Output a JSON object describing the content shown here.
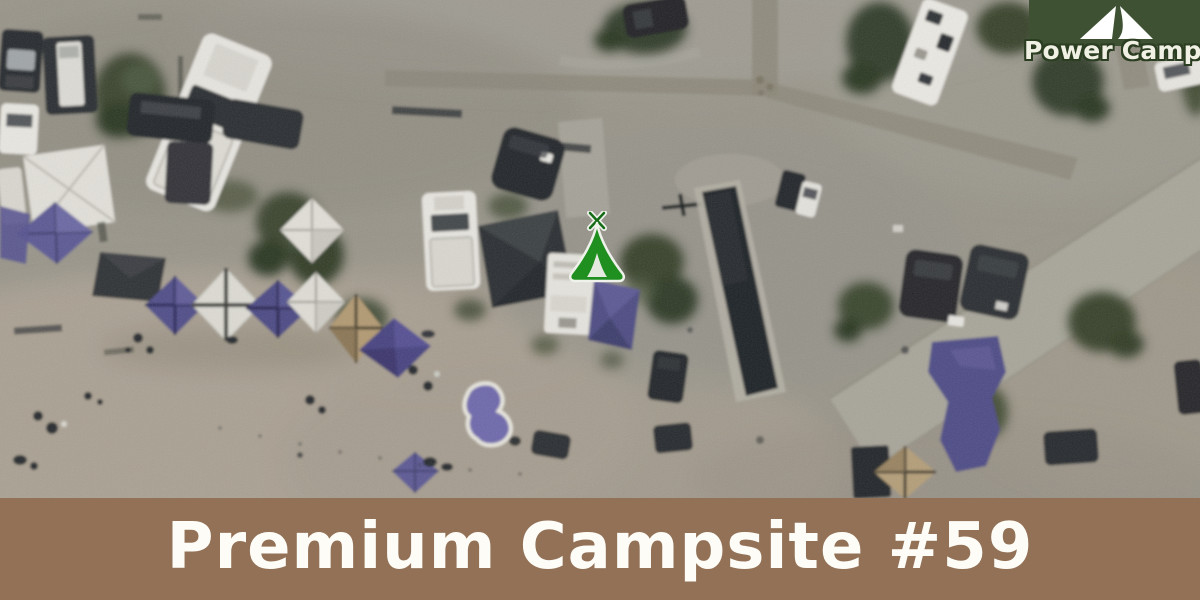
{
  "logo": {
    "brand_name": "Power Camper",
    "icon": "tent-logo-icon"
  },
  "map": {
    "view": "satellite-campground-aerial",
    "marker": {
      "icon": "tent-marker-icon",
      "color": "#1f8f1f"
    }
  },
  "banner": {
    "title": "Premium Campsite #59"
  },
  "colors": {
    "logo_background": "#3e5233",
    "logo_text": "#f1f0e4",
    "banner_background": "#927156",
    "banner_text": "#fdfcf7",
    "marker_green": "#1f8f1f"
  }
}
